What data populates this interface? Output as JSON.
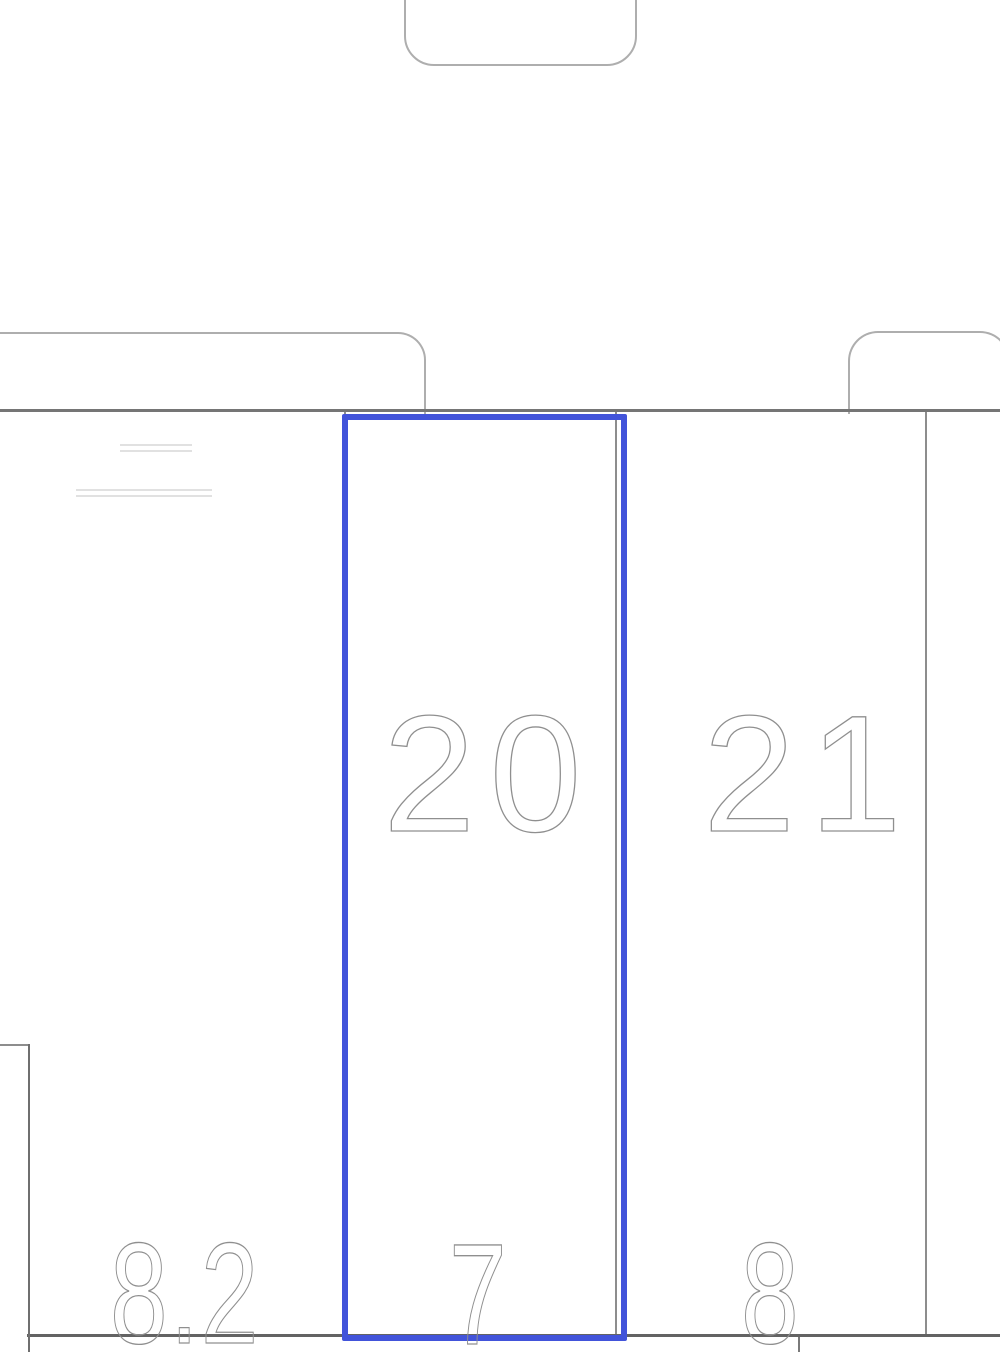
{
  "plan": {
    "spaces": [
      {
        "number": "20",
        "selected": true
      },
      {
        "number": "21",
        "selected": false
      }
    ],
    "bottom_labels": {
      "left": "8.2",
      "center": "7",
      "right": "8"
    },
    "colors": {
      "selection": "#4254da",
      "aisle_line": "#757575",
      "bottom_line": "#636363",
      "divider_line": "#8d8d8d",
      "stall_outline": "#aeaeae",
      "faint_line": "#e1e1e1",
      "digit": "#8f8f8f",
      "background": "#ffffff"
    }
  }
}
